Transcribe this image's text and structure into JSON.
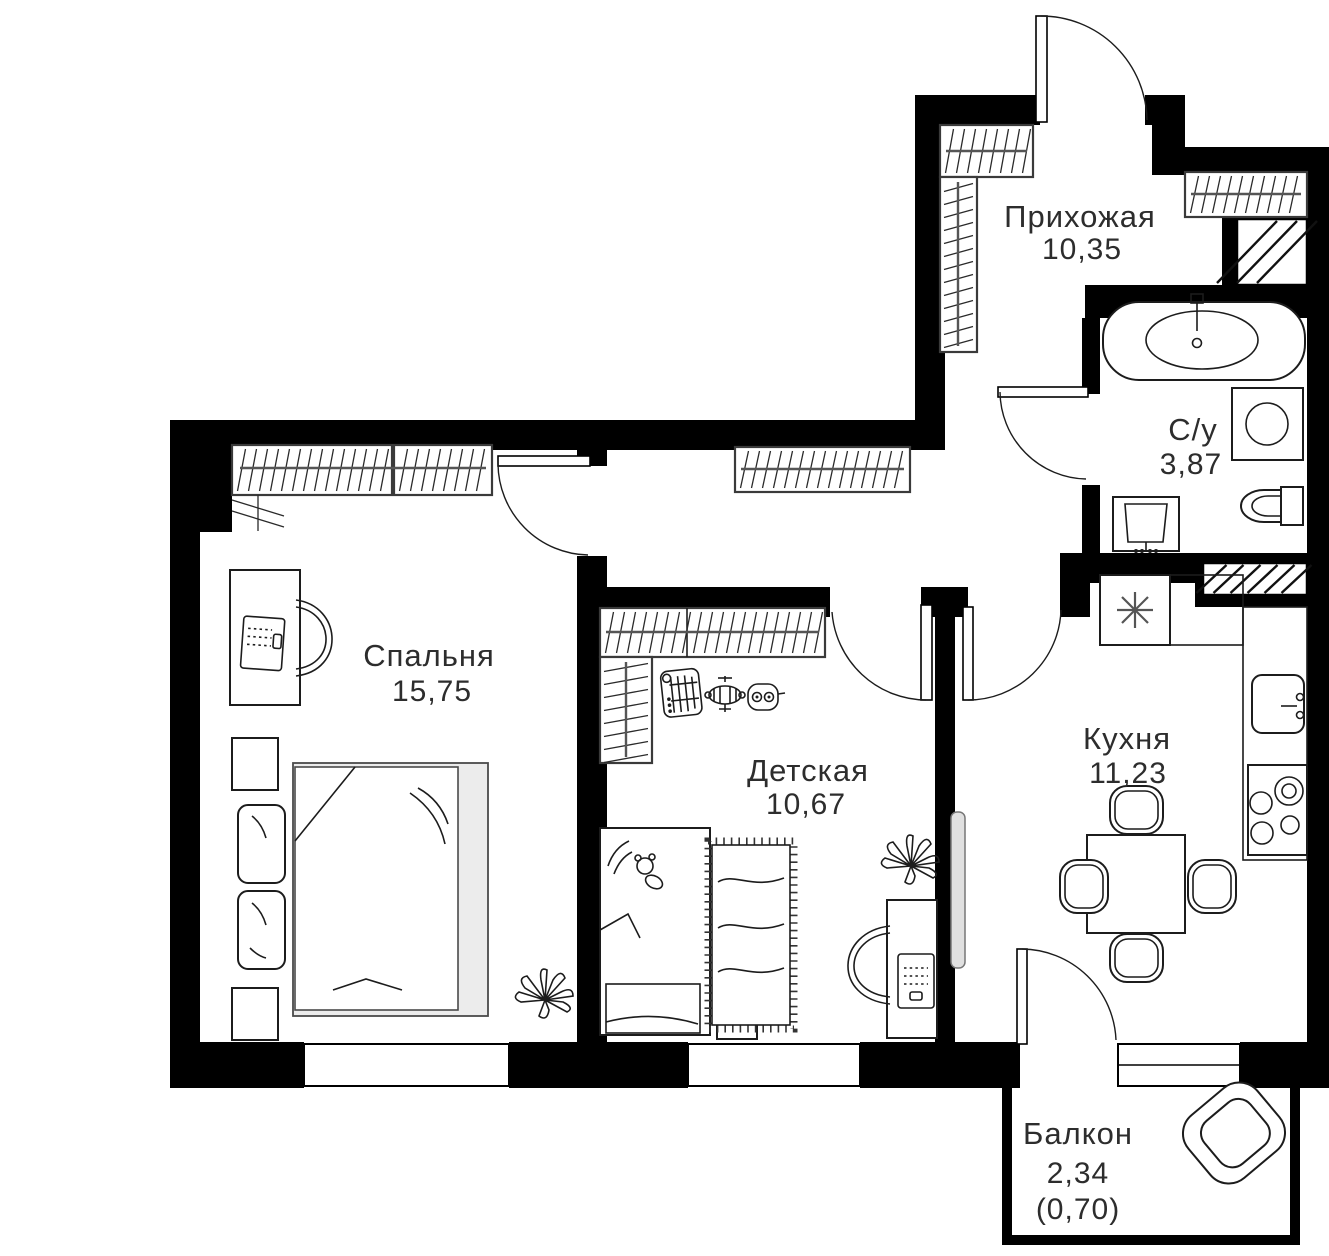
{
  "floorplan": {
    "type": "apartment-floor-plan",
    "rooms": [
      {
        "id": "hallway",
        "name": "Прихожая",
        "area": "10,35"
      },
      {
        "id": "bathroom",
        "name": "С/у",
        "area": "3,87"
      },
      {
        "id": "bedroom",
        "name": "Спальня",
        "area": "15,75"
      },
      {
        "id": "kids_room",
        "name": "Детская",
        "area": "10,67"
      },
      {
        "id": "kitchen",
        "name": "Кухня",
        "area": "11,23"
      },
      {
        "id": "balcony",
        "name": "Балкон",
        "area": "2,34",
        "area_coefficient": "(0,70)"
      }
    ],
    "colors": {
      "walls": "#000000",
      "furniture_line": "#1c1c1c",
      "bed_fill": "#ececec",
      "label_text": "#2d2d2d",
      "background": "#ffffff"
    }
  }
}
